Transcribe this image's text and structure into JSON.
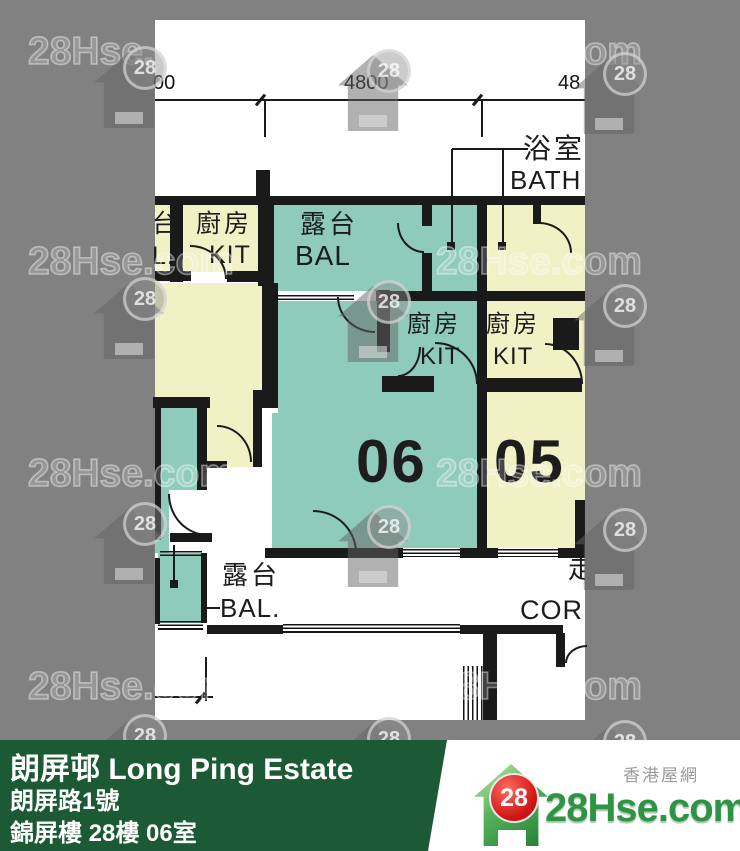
{
  "colors": {
    "gray_bg": "#818181",
    "teal_unit06": "#8ecbba",
    "cream_unit05": "#f0f1c5",
    "wall": "#1a1a1a",
    "banner_green": "#1b5a34",
    "logo_green": "#2e9444",
    "logo_red": "#cc1113"
  },
  "watermark": {
    "text": "28Hse.com",
    "badge": "28"
  },
  "floor_plan": {
    "dim_left": "00",
    "dim_center": "4800",
    "dim_right": "48",
    "bath_zh": "浴室",
    "bath_en": "BATH",
    "kitchen_zh": "廚房",
    "kitchen_en": "KIT",
    "balcony_zh": "露台",
    "balcony_en": "BAL",
    "balcony_bottom_zh": "露台",
    "balcony_bottom_en": "BAL.",
    "partial_balcony_zh": "台",
    "partial_balcony_en": "L.",
    "corridor_zh_partial": "走",
    "corridor_en": "COR",
    "unit06": "06",
    "unit05": "05"
  },
  "banner": {
    "title": "朗屏邨 Long Ping Estate",
    "address": "朗屏路1號",
    "unit_info": "錦屏樓 28樓 06室"
  },
  "logo": {
    "tagline": "香港屋網",
    "site": "28Hse.com",
    "badge": "28"
  }
}
